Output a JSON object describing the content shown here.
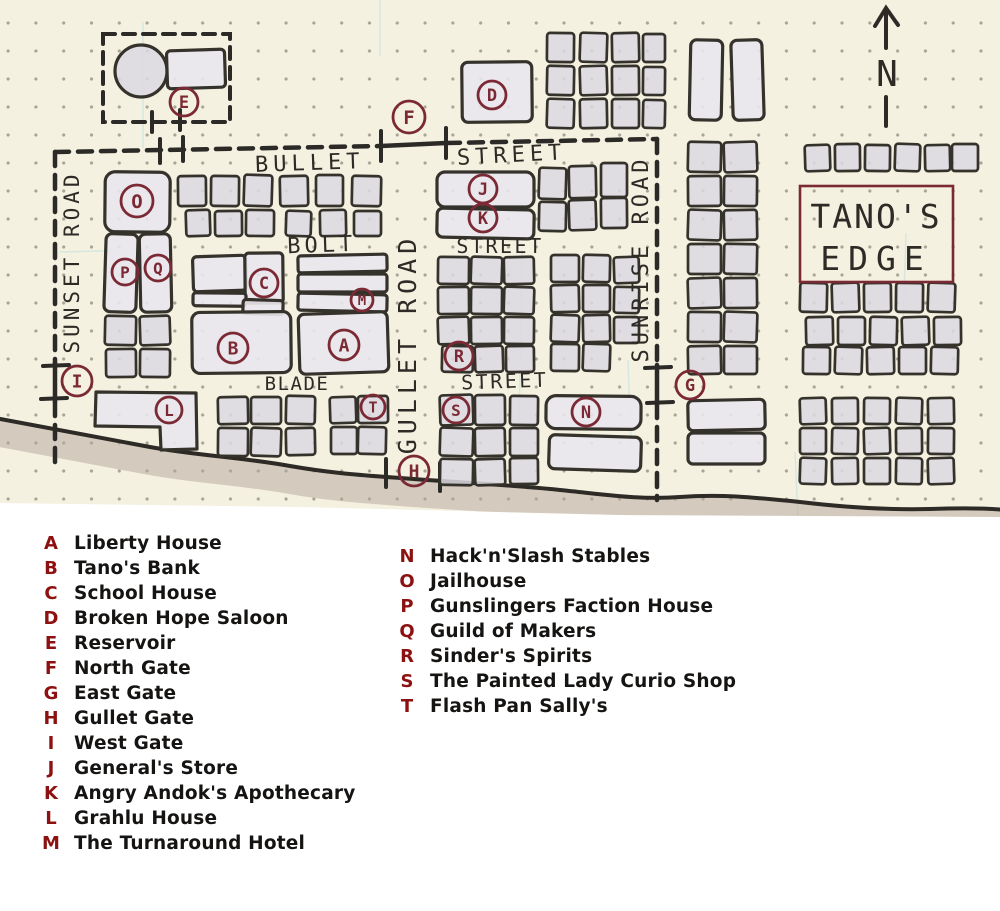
{
  "map": {
    "compass_label": "N",
    "title": {
      "line1": "TANO'S",
      "line2": "EDGE"
    },
    "streets": {
      "bullet": "BULLET",
      "bullet_street": "STREET",
      "bolt": "BOLT",
      "bolt_street": "STREET",
      "blade": "BLADE",
      "blade_street": "STREET",
      "sunset_road": "SUNSET ROAD",
      "gullet_road": "GULLET ROAD",
      "sunrise_road": "SUNRISE ROAD"
    },
    "marker_letters": [
      "A",
      "B",
      "C",
      "D",
      "E",
      "F",
      "G",
      "H",
      "I",
      "J",
      "K",
      "L",
      "M",
      "N",
      "O",
      "P",
      "Q",
      "R",
      "S",
      "T"
    ]
  },
  "legend": {
    "columns": [
      {
        "items": [
          {
            "key": "A",
            "label": "Liberty House"
          },
          {
            "key": "B",
            "label": "Tano's Bank"
          },
          {
            "key": "C",
            "label": "School House"
          },
          {
            "key": "D",
            "label": "Broken Hope Saloon"
          },
          {
            "key": "E",
            "label": "Reservoir"
          },
          {
            "key": "F",
            "label": "North Gate"
          },
          {
            "key": "G",
            "label": "East Gate"
          },
          {
            "key": "H",
            "label": "Gullet Gate"
          },
          {
            "key": "I",
            "label": "West Gate"
          },
          {
            "key": "J",
            "label": "General's Store"
          },
          {
            "key": "K",
            "label": "Angry Andok's Apothecary"
          },
          {
            "key": "L",
            "label": "Grahlu House"
          },
          {
            "key": "M",
            "label": "The Turnaround Hotel"
          }
        ]
      },
      {
        "items": [
          {
            "key": "N",
            "label": "Hack'n'Slash Stables"
          },
          {
            "key": "O",
            "label": "Jailhouse"
          },
          {
            "key": "P",
            "label": "Gunslingers Faction House"
          },
          {
            "key": "Q",
            "label": "Guild of Makers"
          },
          {
            "key": "R",
            "label": "Sinder's Spirits"
          },
          {
            "key": "S",
            "label": "The Painted Lady Curio Shop"
          },
          {
            "key": "T",
            "label": "Flash Pan Sally's"
          }
        ]
      }
    ]
  },
  "colors": {
    "ink": "#2e2b26",
    "marker_red": "#7b2a35",
    "legend_red": "#8e1111",
    "title_red": "#7b2a35",
    "paper": "#f4f1e1",
    "building_fill": "#dcd9e2",
    "building_fill_light": "#e9e7ed",
    "terrain_shade": "#b3a69c"
  }
}
